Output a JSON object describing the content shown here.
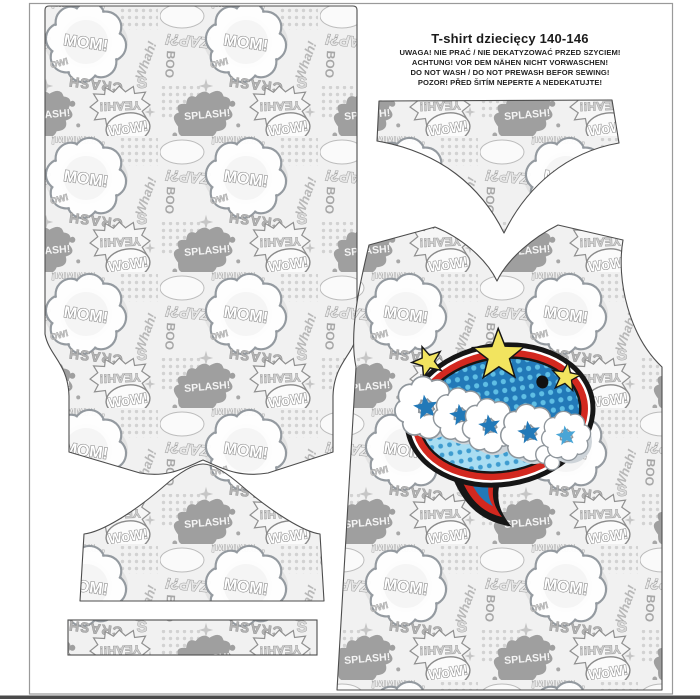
{
  "header": {
    "title": "T-shirt dziecięcy 140-146",
    "warnings": [
      "UWAGA! NIE PRAĆ / NIE DEKATYZOWAĆ PRZED SZYCIEM!",
      "ACHTUNG! VOR DEM NÄHEN NICHT VORWASCHEN!",
      "DO NOT WASH / DO NOT PREWASH BEFOR SEWING!",
      "POZOR! PŘED ŠITÍM NEPERTE A NEDEKATUJTE!"
    ]
  },
  "fabric": {
    "words": {
      "mom": "MOM!",
      "zap": "ZAP?!",
      "yeah": "YEAH!!",
      "crash": "CRASH",
      "splash": "SPLASH!",
      "wow": "WoW!",
      "mmmm": "¡MMMM...",
      "whah": "Whah!",
      "boo": "BOO",
      "ow": "OW!",
      "s": "S"
    }
  },
  "graphic": {
    "word": "OOOPS",
    "colors": {
      "blue": "#2279B8",
      "dot_light": "#5FBEE4",
      "light_blue": "#A9DDF2",
      "dot_mid": "#3E9CD0",
      "red": "#D3281F",
      "yellow": "#F2E45F",
      "outline": "#161616"
    }
  }
}
